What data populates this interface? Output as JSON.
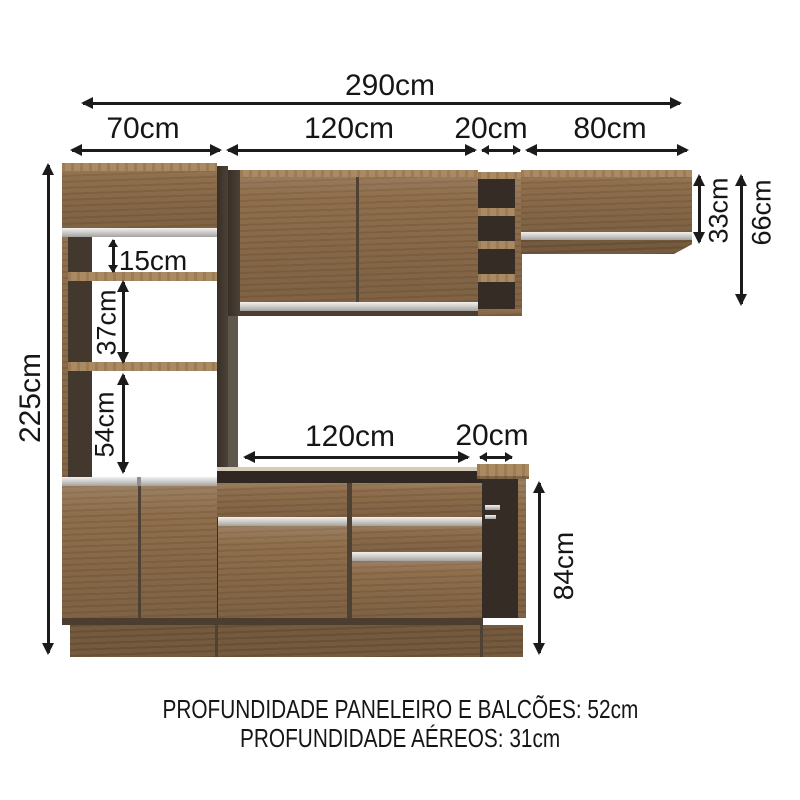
{
  "diagram": {
    "top_dims": {
      "total": "290cm",
      "tower": "70cm",
      "upper_cabinet": "120cm",
      "open_niche": "20cm",
      "right_cabinet": "80cm"
    },
    "side_dims": {
      "total_height": "225cm",
      "right_cabinet_height": "33cm",
      "upper_section_height": "66cm"
    },
    "tower_dims": {
      "top_gap": "15cm",
      "middle_gap": "37cm",
      "lower_gap": "54cm"
    },
    "counter_dims": {
      "width": "120cm",
      "open_niche": "20cm",
      "height": "84cm"
    },
    "footer": {
      "line1": "PROFUNDIDADE PANELEIRO E BALCÕES: 52cm",
      "line2": "PROFUNDIDADE AÉREOS: 31cm"
    },
    "colors": {
      "wood": "#8a6946",
      "wood_light": "#a5845a",
      "side_panel_dark": "#3f352b",
      "interior_dark": "#342c25",
      "aluminum": "#cfcecb",
      "arrow": "#1b1b1b",
      "background": "#ffffff"
    }
  }
}
